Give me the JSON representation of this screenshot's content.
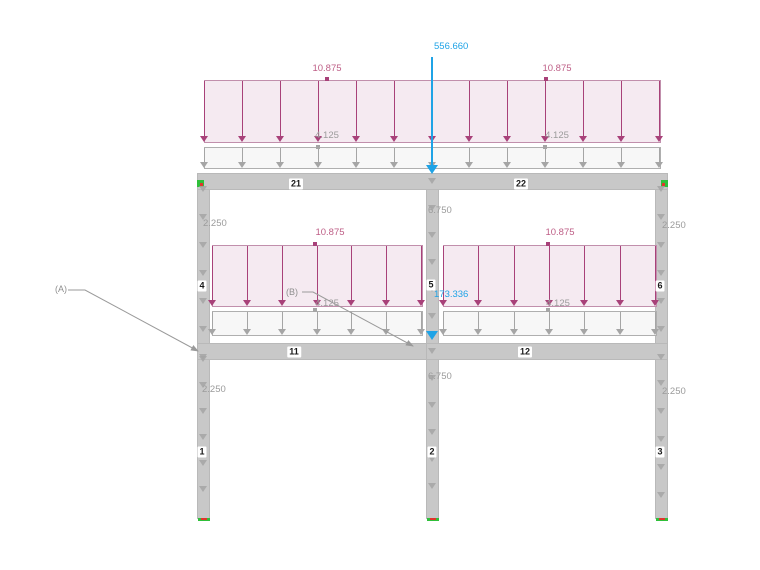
{
  "loads": {
    "top_point": "556.660",
    "mid_point": "173.336",
    "surface_pink": "10.875",
    "surface_gray": "4.125",
    "column_outer": "2.250",
    "column_middle": "6.750"
  },
  "members": {
    "beam_21": "21",
    "beam_22": "22",
    "beam_11": "11",
    "beam_12": "12",
    "col_4": "4",
    "col_5": "5",
    "col_6": "6",
    "col_1": "1",
    "col_2": "2",
    "col_3": "3"
  },
  "annotations": {
    "label_a": "(A)",
    "label_b": "(B)"
  },
  "colors": {
    "pink_arrow": "#A84179",
    "pink_fill": "#F5EAF1",
    "pink_border": "#C18FAC",
    "pink_text": "#BE5E86",
    "gray_arrow": "#A5A5A5",
    "gray_fill": "#F7F7F7",
    "gray_border": "#AFAFAF",
    "gray_text": "#9B9B9B",
    "blue": "#1FA3E6",
    "structure": "#C8C8C8",
    "structure_border": "#B9B9B9",
    "support_green": "#2FBF3A",
    "support_red": "#E0362C"
  }
}
